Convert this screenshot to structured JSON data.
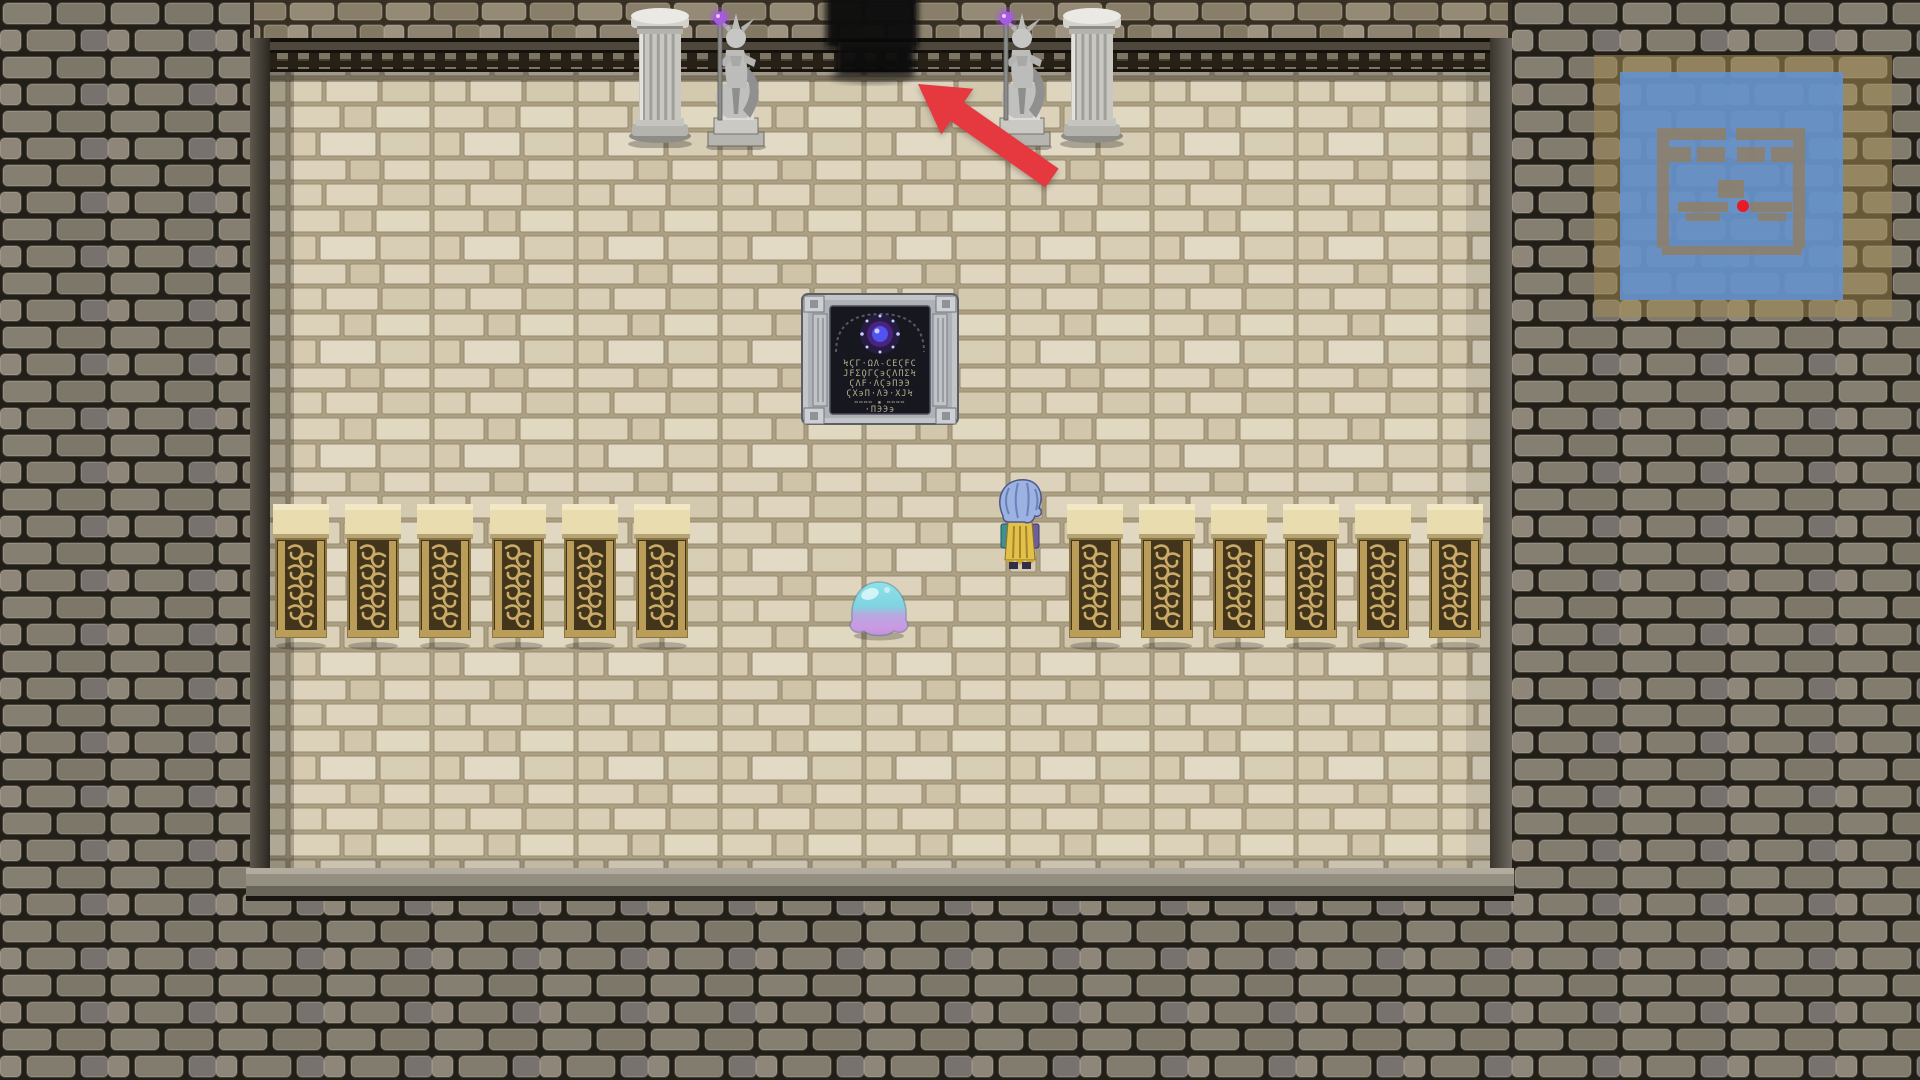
{
  "scene": {
    "label": "stone dungeon chamber, top-down view",
    "tablet": {
      "rune_lines": [
        "ϞϚΓ·ΩΛ-ϹΕϚϜϹ",
        "ЈϜΣϘΓϚ϶ϚΛΠΣϞ",
        "ϚΛϜ·ΛϚ϶ΠЭЭ",
        "ϚΧ϶Π·ΛЭ·ΧЈϞ",
        "╍╍╍╍ ▪ ╍╍╍╍",
        "·ΠЭЭ϶"
      ]
    },
    "entities": {
      "player": "hero sprite facing north",
      "creature": "cyan-purple slime",
      "statues": "2 stone guardian statues holding orb staffs",
      "pillars": "2 marble pillars",
      "banners": "12 ornate gold-scroll wall panels",
      "doorway": "dark exit at top center"
    },
    "minimap": {
      "player_dot_color": "#e81b24",
      "area_color": "#6292d0",
      "frame_color": "#a38d54"
    },
    "annotation": {
      "type": "red arrow pointing to north doorway",
      "arrow_color": "#e5383f"
    }
  },
  "colors": {
    "arrow-red": "#e5383f",
    "dot-red": "#e81b24",
    "minimap-blue": "rgba(98,146,208,0.88)",
    "minimap-frame": "rgba(163,141,84,0.55)",
    "orb-purple": "#a55ae0",
    "orb-blue": "#5252f2",
    "slime-cyan": "#7fd4e0",
    "slime-purple": "#c79ae2",
    "cape-yellow": "#e2c049",
    "hair-blue": "#9cb2e0"
  }
}
